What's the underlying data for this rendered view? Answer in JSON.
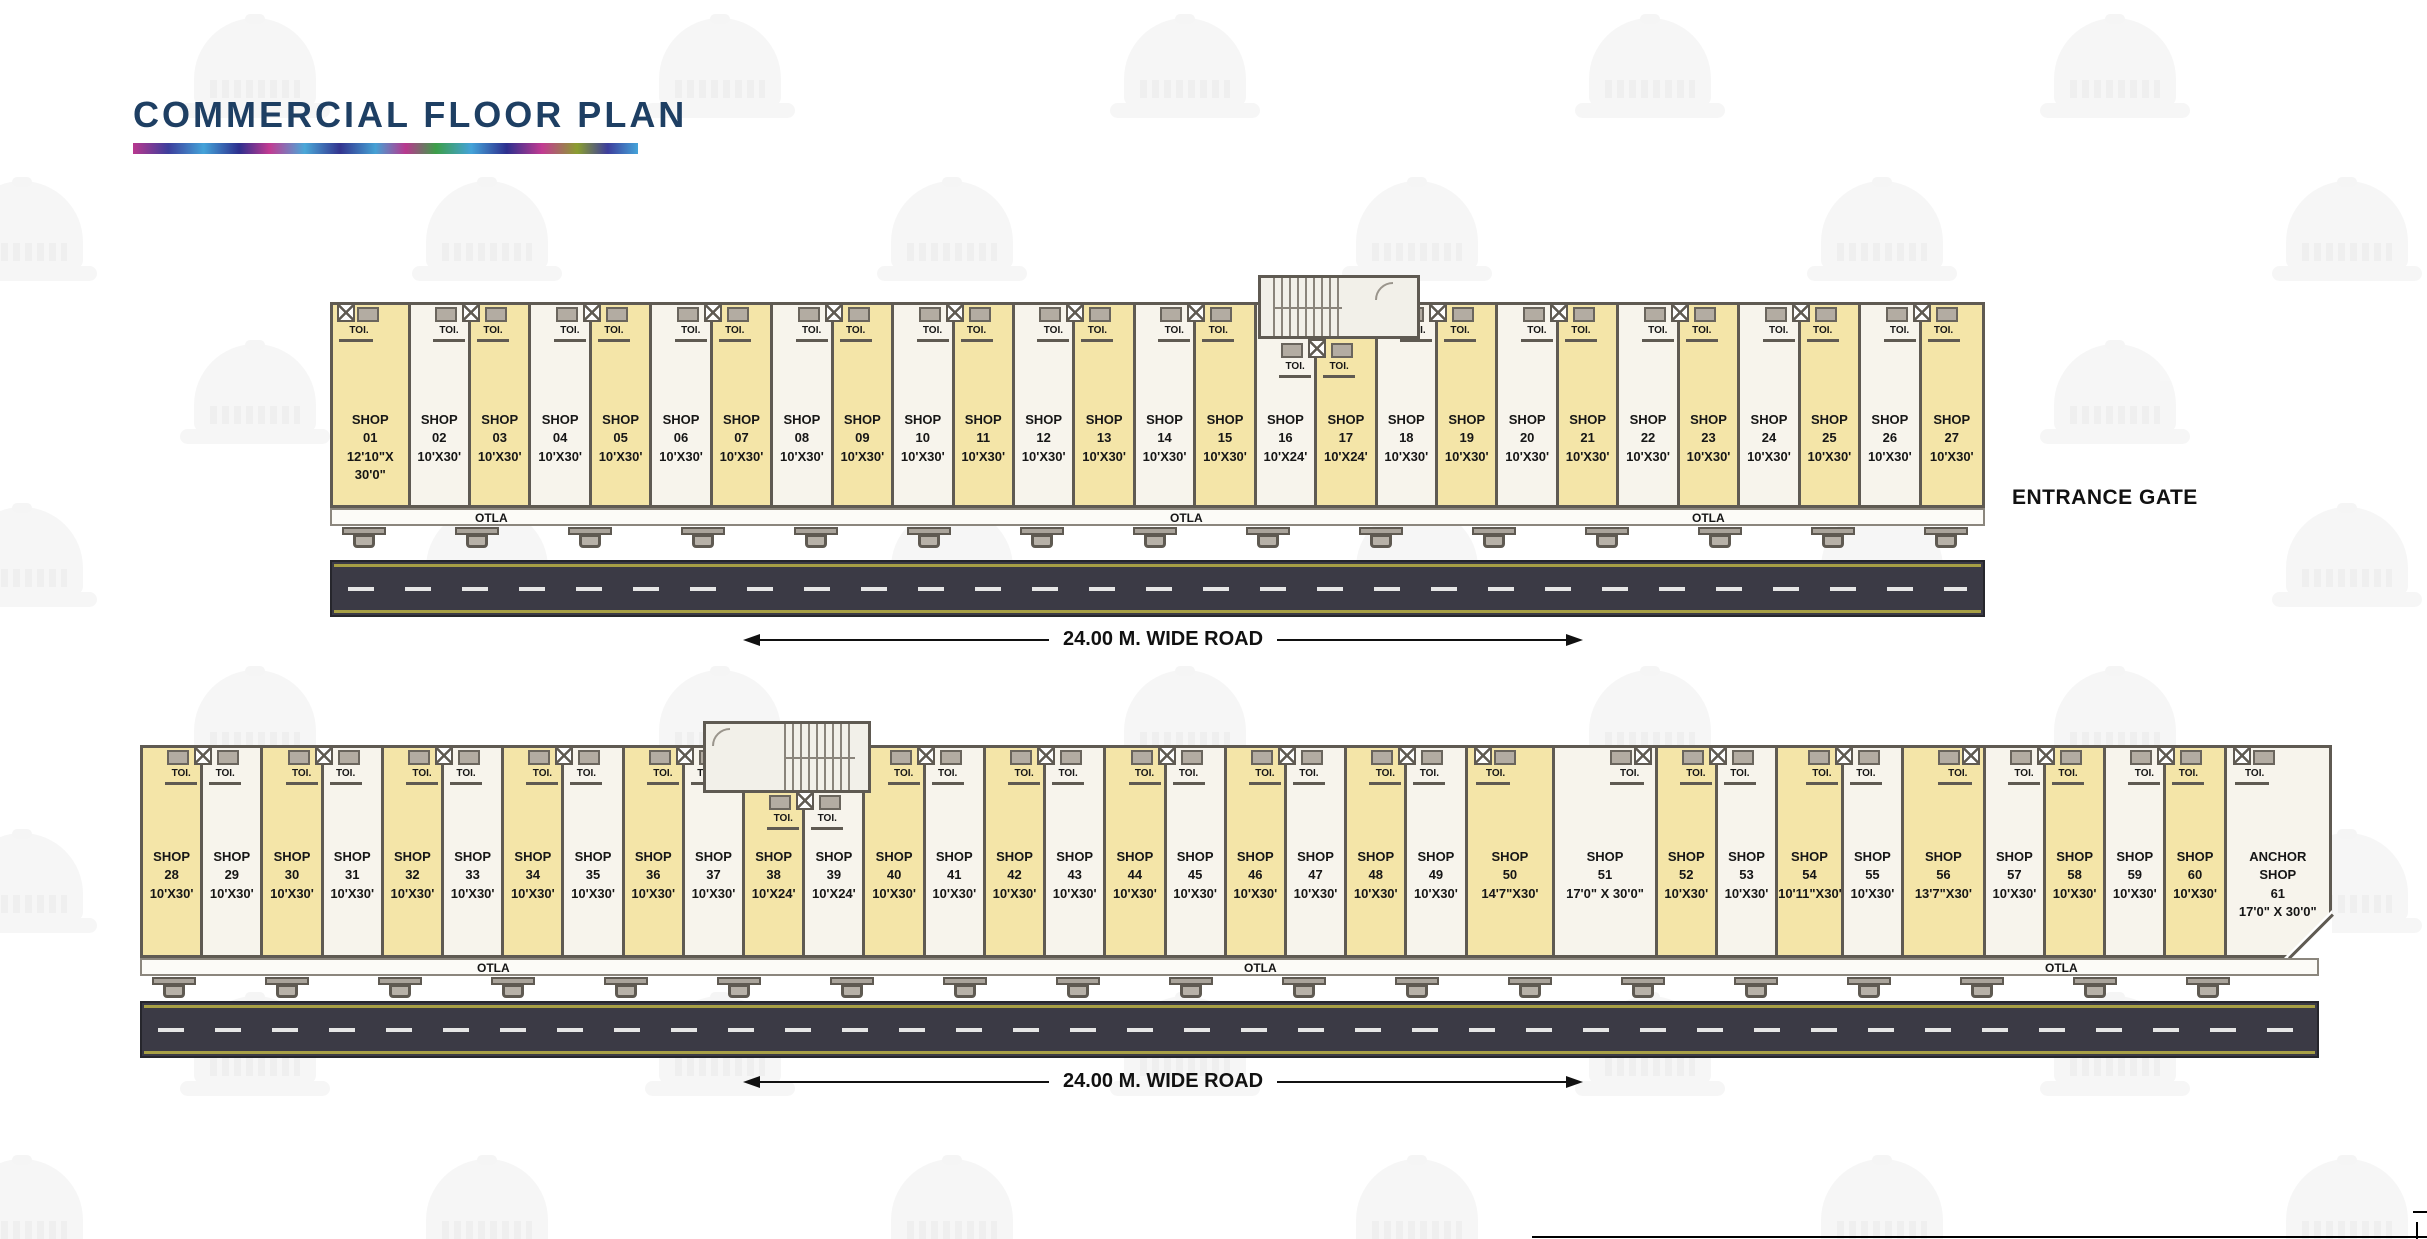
{
  "title": "COMMERCIAL FLOOR PLAN",
  "entrance_gate_label": "ENTRANCE GATE",
  "road_label": "24.00 M. WIDE ROAD",
  "otla_label": "OTLA",
  "toi_label": "TOI.",
  "colors": {
    "shop_yellow": "#f4e5a8",
    "shop_white": "#f7f4ec",
    "wall": "#5f5a52",
    "road": "#3b3a45",
    "road_edge": "#a79f45",
    "title_navy": "#1e3f63"
  },
  "buildings": {
    "top": {
      "otla_positions": [
        163,
        858,
        1380
      ],
      "shops": [
        {
          "lines": [
            "SHOP",
            "01",
            "12'10\"X",
            "30'0\""
          ],
          "w_ft": 12.83,
          "color": "y",
          "toi": "corner"
        },
        {
          "lines": [
            "SHOP",
            "02",
            "10'X30'"
          ],
          "w_ft": 10,
          "color": "w",
          "toi": "right"
        },
        {
          "lines": [
            "SHOP",
            "03",
            "10'X30'"
          ],
          "w_ft": 10,
          "color": "y",
          "toi": "left"
        },
        {
          "lines": [
            "SHOP",
            "04",
            "10'X30'"
          ],
          "w_ft": 10,
          "color": "w",
          "toi": "right"
        },
        {
          "lines": [
            "SHOP",
            "05",
            "10'X30'"
          ],
          "w_ft": 10,
          "color": "y",
          "toi": "left"
        },
        {
          "lines": [
            "SHOP",
            "06",
            "10'X30'"
          ],
          "w_ft": 10,
          "color": "w",
          "toi": "right"
        },
        {
          "lines": [
            "SHOP",
            "07",
            "10'X30'"
          ],
          "w_ft": 10,
          "color": "y",
          "toi": "left"
        },
        {
          "lines": [
            "SHOP",
            "08",
            "10'X30'"
          ],
          "w_ft": 10,
          "color": "w",
          "toi": "right"
        },
        {
          "lines": [
            "SHOP",
            "09",
            "10'X30'"
          ],
          "w_ft": 10,
          "color": "y",
          "toi": "left"
        },
        {
          "lines": [
            "SHOP",
            "10",
            "10'X30'"
          ],
          "w_ft": 10,
          "color": "w",
          "toi": "right"
        },
        {
          "lines": [
            "SHOP",
            "11",
            "10'X30'"
          ],
          "w_ft": 10,
          "color": "y",
          "toi": "left"
        },
        {
          "lines": [
            "SHOP",
            "12",
            "10'X30'"
          ],
          "w_ft": 10,
          "color": "w",
          "toi": "right"
        },
        {
          "lines": [
            "SHOP",
            "13",
            "10'X30'"
          ],
          "w_ft": 10,
          "color": "y",
          "toi": "left"
        },
        {
          "lines": [
            "SHOP",
            "14",
            "10'X30'"
          ],
          "w_ft": 10,
          "color": "w",
          "toi": "right"
        },
        {
          "lines": [
            "SHOP",
            "15",
            "10'X30'"
          ],
          "w_ft": 10,
          "color": "y",
          "toi": "left"
        },
        {
          "lines": [
            "SHOP",
            "16",
            "10'X24'"
          ],
          "w_ft": 10,
          "color": "w",
          "toi": "right-low"
        },
        {
          "lines": [
            "SHOP",
            "17",
            "10'X24'"
          ],
          "w_ft": 10,
          "color": "y",
          "toi": "left-low"
        },
        {
          "lines": [
            "SHOP",
            "18",
            "10'X30'"
          ],
          "w_ft": 10,
          "color": "w",
          "toi": "right"
        },
        {
          "lines": [
            "SHOP",
            "19",
            "10'X30'"
          ],
          "w_ft": 10,
          "color": "y",
          "toi": "left"
        },
        {
          "lines": [
            "SHOP",
            "20",
            "10'X30'"
          ],
          "w_ft": 10,
          "color": "w",
          "toi": "right"
        },
        {
          "lines": [
            "SHOP",
            "21",
            "10'X30'"
          ],
          "w_ft": 10,
          "color": "y",
          "toi": "left"
        },
        {
          "lines": [
            "SHOP",
            "22",
            "10'X30'"
          ],
          "w_ft": 10,
          "color": "w",
          "toi": "right"
        },
        {
          "lines": [
            "SHOP",
            "23",
            "10'X30'"
          ],
          "w_ft": 10,
          "color": "y",
          "toi": "left"
        },
        {
          "lines": [
            "SHOP",
            "24",
            "10'X30'"
          ],
          "w_ft": 10,
          "color": "w",
          "toi": "right"
        },
        {
          "lines": [
            "SHOP",
            "25",
            "10'X30'"
          ],
          "w_ft": 10,
          "color": "y",
          "toi": "left"
        },
        {
          "lines": [
            "SHOP",
            "26",
            "10'X30'"
          ],
          "w_ft": 10,
          "color": "w",
          "toi": "right"
        },
        {
          "lines": [
            "SHOP",
            "27",
            "10'X30'"
          ],
          "w_ft": 10,
          "color": "y",
          "toi": "left"
        }
      ]
    },
    "bottom": {
      "otla_positions": [
        355,
        1122,
        1923
      ],
      "shops": [
        {
          "lines": [
            "SHOP",
            "28",
            "10'X30'"
          ],
          "w_ft": 10,
          "color": "y",
          "toi": "right"
        },
        {
          "lines": [
            "SHOP",
            "29",
            "10'X30'"
          ],
          "w_ft": 10,
          "color": "w",
          "toi": "left"
        },
        {
          "lines": [
            "SHOP",
            "30",
            "10'X30'"
          ],
          "w_ft": 10,
          "color": "y",
          "toi": "right"
        },
        {
          "lines": [
            "SHOP",
            "31",
            "10'X30'"
          ],
          "w_ft": 10,
          "color": "w",
          "toi": "left"
        },
        {
          "lines": [
            "SHOP",
            "32",
            "10'X30'"
          ],
          "w_ft": 10,
          "color": "y",
          "toi": "right"
        },
        {
          "lines": [
            "SHOP",
            "33",
            "10'X30'"
          ],
          "w_ft": 10,
          "color": "w",
          "toi": "left"
        },
        {
          "lines": [
            "SHOP",
            "34",
            "10'X30'"
          ],
          "w_ft": 10,
          "color": "y",
          "toi": "right"
        },
        {
          "lines": [
            "SHOP",
            "35",
            "10'X30'"
          ],
          "w_ft": 10,
          "color": "w",
          "toi": "left"
        },
        {
          "lines": [
            "SHOP",
            "36",
            "10'X30'"
          ],
          "w_ft": 10,
          "color": "y",
          "toi": "right"
        },
        {
          "lines": [
            "SHOP",
            "37",
            "10'X30'"
          ],
          "w_ft": 10,
          "color": "w",
          "toi": "left"
        },
        {
          "lines": [
            "SHOP",
            "38",
            "10'X24'"
          ],
          "w_ft": 10,
          "color": "y",
          "toi": "right-low"
        },
        {
          "lines": [
            "SHOP",
            "39",
            "10'X24'"
          ],
          "w_ft": 10,
          "color": "w",
          "toi": "left-low"
        },
        {
          "lines": [
            "SHOP",
            "40",
            "10'X30'"
          ],
          "w_ft": 10,
          "color": "y",
          "toi": "right"
        },
        {
          "lines": [
            "SHOP",
            "41",
            "10'X30'"
          ],
          "w_ft": 10,
          "color": "w",
          "toi": "left"
        },
        {
          "lines": [
            "SHOP",
            "42",
            "10'X30'"
          ],
          "w_ft": 10,
          "color": "y",
          "toi": "right"
        },
        {
          "lines": [
            "SHOP",
            "43",
            "10'X30'"
          ],
          "w_ft": 10,
          "color": "w",
          "toi": "left"
        },
        {
          "lines": [
            "SHOP",
            "44",
            "10'X30'"
          ],
          "w_ft": 10,
          "color": "y",
          "toi": "right"
        },
        {
          "lines": [
            "SHOP",
            "45",
            "10'X30'"
          ],
          "w_ft": 10,
          "color": "w",
          "toi": "left"
        },
        {
          "lines": [
            "SHOP",
            "46",
            "10'X30'"
          ],
          "w_ft": 10,
          "color": "y",
          "toi": "right"
        },
        {
          "lines": [
            "SHOP",
            "47",
            "10'X30'"
          ],
          "w_ft": 10,
          "color": "w",
          "toi": "left"
        },
        {
          "lines": [
            "SHOP",
            "48",
            "10'X30'"
          ],
          "w_ft": 10,
          "color": "y",
          "toi": "right"
        },
        {
          "lines": [
            "SHOP",
            "49",
            "10'X30'"
          ],
          "w_ft": 10,
          "color": "w",
          "toi": "left"
        },
        {
          "lines": [
            "SHOP",
            "50",
            "14'7\"X30'"
          ],
          "w_ft": 14.58,
          "color": "y",
          "toi": "single-left"
        },
        {
          "lines": [
            "SHOP",
            "51",
            "17'0\" X 30'0\""
          ],
          "w_ft": 17,
          "color": "w",
          "toi": "single-right"
        },
        {
          "lines": [
            "SHOP",
            "52",
            "10'X30'"
          ],
          "w_ft": 10,
          "color": "y",
          "toi": "right"
        },
        {
          "lines": [
            "SHOP",
            "53",
            "10'X30'"
          ],
          "w_ft": 10,
          "color": "w",
          "toi": "left"
        },
        {
          "lines": [
            "SHOP",
            "54",
            "10'11\"X30'"
          ],
          "w_ft": 10.92,
          "color": "y",
          "toi": "right"
        },
        {
          "lines": [
            "SHOP",
            "55",
            "10'X30'"
          ],
          "w_ft": 10,
          "color": "w",
          "toi": "left"
        },
        {
          "lines": [
            "SHOP",
            "56",
            "13'7\"X30'"
          ],
          "w_ft": 13.58,
          "color": "y",
          "toi": "single-right"
        },
        {
          "lines": [
            "SHOP",
            "57",
            "10'X30'"
          ],
          "w_ft": 10,
          "color": "w",
          "toi": "right"
        },
        {
          "lines": [
            "SHOP",
            "58",
            "10'X30'"
          ],
          "w_ft": 10,
          "color": "y",
          "toi": "left"
        },
        {
          "lines": [
            "SHOP",
            "59",
            "10'X30'"
          ],
          "w_ft": 10,
          "color": "w",
          "toi": "right"
        },
        {
          "lines": [
            "SHOP",
            "60",
            "10'X30'"
          ],
          "w_ft": 10,
          "color": "y",
          "toi": "left"
        },
        {
          "lines": [
            "ANCHOR",
            "SHOP",
            "61",
            "17'0\" X 30'0\""
          ],
          "w_ft": 17,
          "color": "w",
          "toi": "single-left",
          "chamfer": true
        }
      ]
    }
  }
}
